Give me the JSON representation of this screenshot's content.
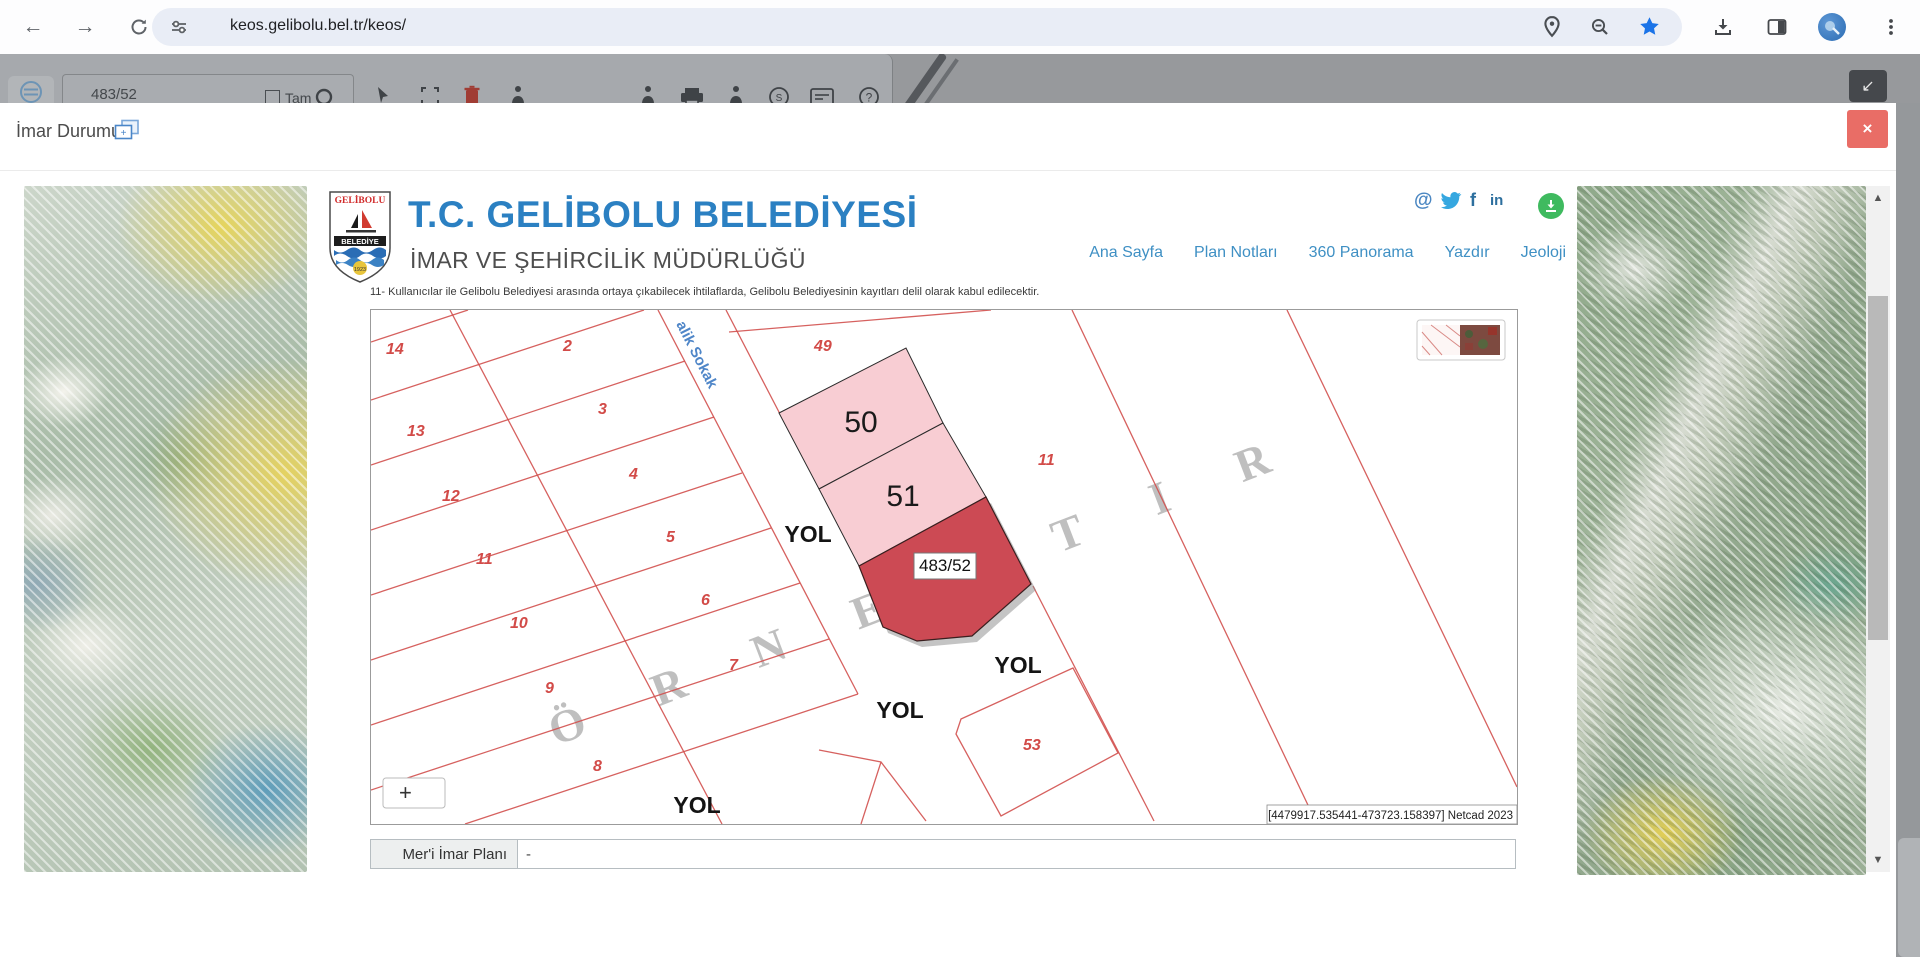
{
  "browser": {
    "url": "keos.gelibolu.bel.tr/keos/"
  },
  "bg_toolbar": {
    "search_value": "483/52",
    "checkbox_label": "Tam"
  },
  "modal": {
    "title": "İmar Durumu",
    "close_glyph": "×"
  },
  "site": {
    "logo_top": "GELİBOLU",
    "logo_band": "BELEDİYE",
    "logo_year": "1923",
    "title": "T.C. GELİBOLU BELEDİYESİ",
    "subtitle": "İMAR VE ŞEHİRCİLİK MÜDÜRLÜĞÜ",
    "disclaimer": "11- Kullanıcılar ile Gelibolu Belediyesi arasında ortaya çıkabilecek ihtilaflarda, Gelibolu Belediyesinin kayıtları delil olarak kabul edilecektir.",
    "social_at": "@",
    "social_f": "f",
    "social_in": "in",
    "nav": [
      {
        "label": "Ana Sayfa"
      },
      {
        "label": "Plan Notları"
      },
      {
        "label": "360 Panorama"
      },
      {
        "label": "Yazdır"
      },
      {
        "label": "Jeoloji"
      }
    ]
  },
  "map": {
    "parcels": [
      "14",
      "2",
      "49",
      "13",
      "3",
      "12",
      "4",
      "11",
      "5",
      "10",
      "6",
      "9",
      "7",
      "8",
      "11",
      "53"
    ],
    "highlight_50": "50",
    "highlight_51": "51",
    "selected_parcel": "483/52",
    "street_name": "alik Sokak",
    "watermark": "ÖRNEKTIR",
    "road_labels": [
      "YOL",
      "YOL",
      "YOL",
      "YOL"
    ],
    "coordinates": "[4479917.535441-473723.158397] Netcad 2023",
    "zoom_in": "+"
  },
  "info_row": {
    "label": "Mer'i İmar Planı",
    "value": "-"
  },
  "colors": {
    "accent_blue": "#2b80c2",
    "link_blue": "#3f90c4",
    "selected_red": "#cc4a54",
    "parcel_pink": "#f8cdd3",
    "line_red": "#d2504e",
    "close_red": "#e96d66",
    "download_green": "#3fba5f"
  }
}
